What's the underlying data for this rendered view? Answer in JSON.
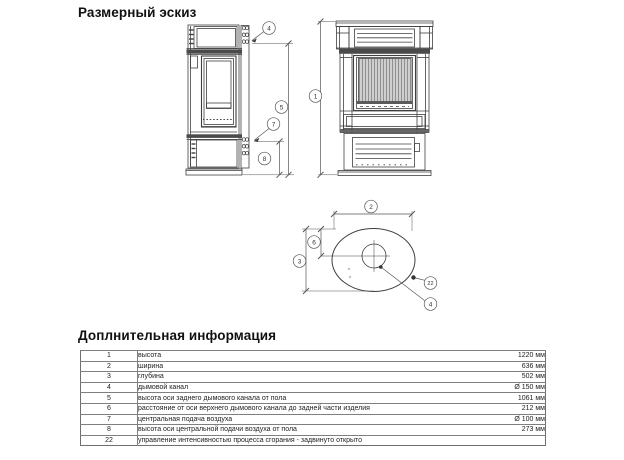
{
  "headings": {
    "sketch": "Размерный эскиз",
    "info": "Доплнительная информация"
  },
  "drawing": {
    "callouts": {
      "c1": "1",
      "c2": "2",
      "c3": "3",
      "c4": "4",
      "c5": "5",
      "c6": "6",
      "c7": "7",
      "c8": "8",
      "c22": "22"
    }
  },
  "table": {
    "rows": [
      {
        "num": "1",
        "desc": "высота",
        "value": "1220 мм"
      },
      {
        "num": "2",
        "desc": "ширина",
        "value": "636 мм"
      },
      {
        "num": "3",
        "desc": "глубина",
        "value": "502 мм"
      },
      {
        "num": "4",
        "desc": "дымовой канал",
        "value": "Ø 150 мм"
      },
      {
        "num": "5",
        "desc": "высота оси заднего дымового канала от пола",
        "value": "1061 мм"
      },
      {
        "num": "6",
        "desc": "расстояние от оси верхнего дымового канала до задней части изделия",
        "value": "212 мм"
      },
      {
        "num": "7",
        "desc": "центральная подача воздуха",
        "value": "Ø 100 мм"
      },
      {
        "num": "8",
        "desc": "высота оси центральной подачи воздуха от пола",
        "value": "273 мм"
      },
      {
        "num": "22",
        "desc": "управление интенсивностью процесса сгорания - задвинуто открыто",
        "value": ""
      }
    ]
  }
}
